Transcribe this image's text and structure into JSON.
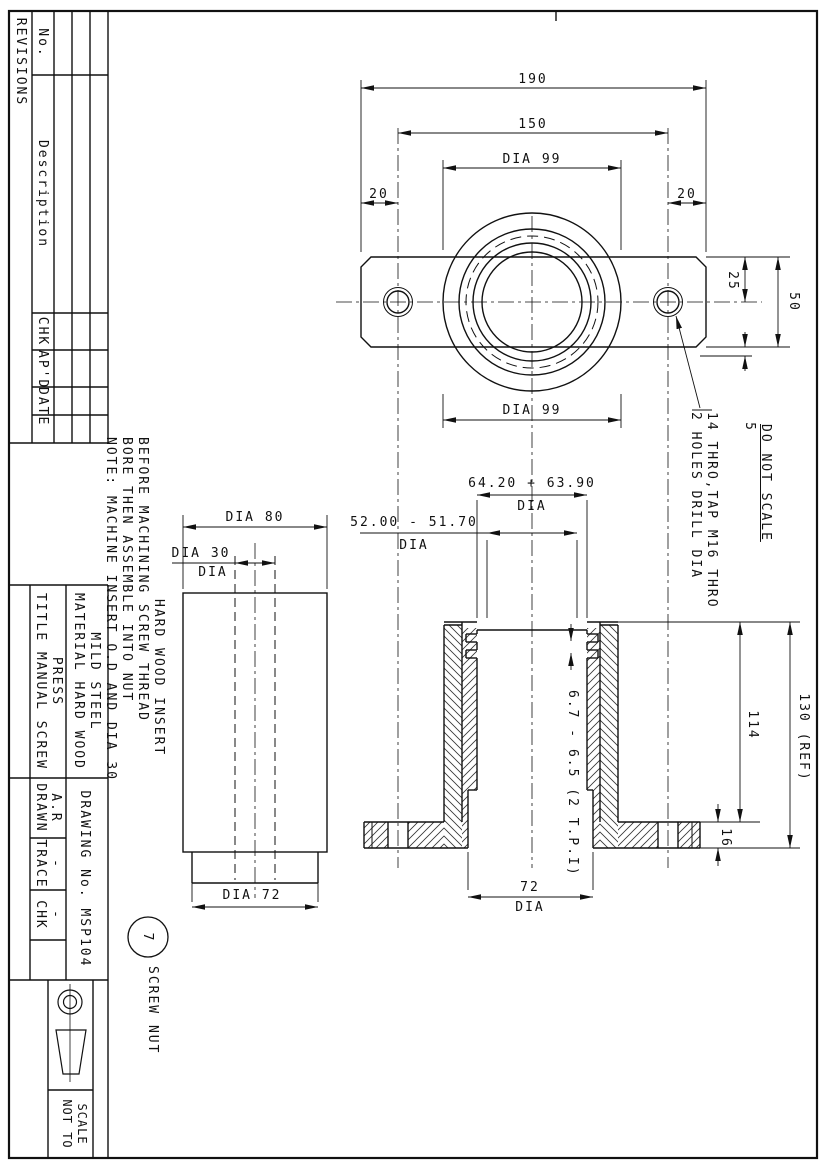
{
  "sheet": {
    "do_not_scale": "DO NOT SCALE"
  },
  "revisions": {
    "title": "REVISIONS",
    "col_no": "No.",
    "col_description": "Description",
    "col_chk": "CHK",
    "col_apd": "AP'D",
    "col_date": "DATE"
  },
  "title_block": {
    "title_line1": "TITLE MANUAL SCREW",
    "title_line2": "PRESS",
    "material_line1": "MATERIAL HARD WOOD",
    "material_line2": "MILD STEEL",
    "drawn_label": "DRAWN",
    "drawn_value": "A.R",
    "trace_label": "TRACE",
    "trace_value": "-",
    "chk_label": "CHK",
    "chk_value": "-",
    "drawing_no": "DRAWING No. MSP104",
    "scale_line1": "NOT TO",
    "scale_line2": "SCALE"
  },
  "notes": {
    "line1": "NOTE: MACHINE INSERT O.D AND DIA 30",
    "line2": "BORE THEN ASSEMBLE INTO NUT",
    "line3": "BEFORE MACHINING SCREW THREAD"
  },
  "plan_view": {
    "dim_overall": "190",
    "dim_hole_centres": "150",
    "dim_boss_top": "DIA 99",
    "dim_edge_left": "20",
    "dim_edge_right": "20",
    "dim_boss_bottom": "DIA 99",
    "dim_hole_offset": "25",
    "dim_plate_width": "50",
    "dim_step": "5",
    "holes_note_line1": "2 HOLES DRILL DIA",
    "holes_note_line2": "14 THRO,TAP M16 THRO"
  },
  "insert_view": {
    "label": "HARD WOOD INSERT",
    "dim_od": "DIA 80",
    "dim_bore": "DIA 30",
    "dim_bore_suffix": "DIA",
    "dim_spigot": "DIA 72"
  },
  "section_view": {
    "dim_thread_major": "64.20 + 63.90",
    "dim_thread_major_suffix": "DIA",
    "dim_thread_minor": "52.00 - 51.70",
    "dim_thread_minor_suffix": "DIA",
    "dim_pitch": "6.7 - 6.5 (2 T.P.I)",
    "dim_height": "114",
    "dim_overall": "130 (REF)",
    "dim_flange": "16",
    "dim_bore": "72",
    "dim_bore_suffix": "DIA"
  },
  "balloon": {
    "number": "7",
    "label": "SCREW NUT"
  }
}
